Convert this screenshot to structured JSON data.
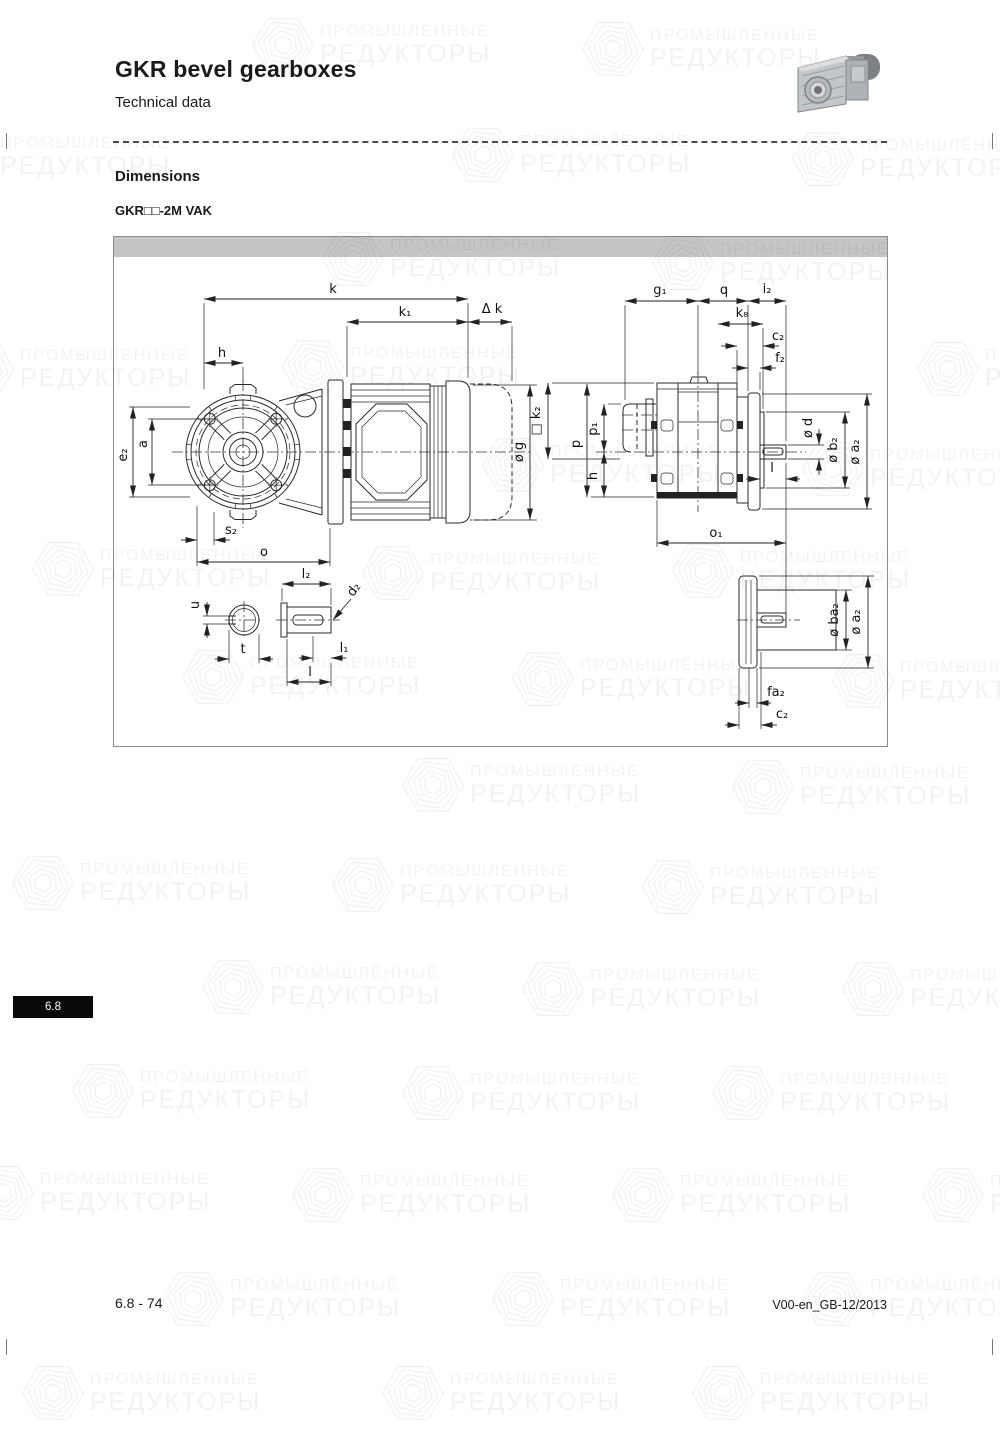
{
  "page": {
    "title": "GKR bevel gearboxes",
    "subtitle": "Technical data",
    "section_heading": "Dimensions",
    "variant_label": "GKR□□-2M VAK",
    "tab_label": "6.8",
    "footer_left": "6.8 - 74",
    "footer_right": "V00-en_GB-12/2013"
  },
  "watermark": {
    "line1": "ПРОМЫШЛЕННЫЕ",
    "line2": "РЕДУКТОРЫ"
  },
  "colors": {
    "panel_bar": "#c5c5c5",
    "tab_bg": "#0a0a0a",
    "line": "#2a2a2a"
  },
  "dims": {
    "k": "k",
    "k1": "k₁",
    "dk": "Δ k",
    "h": "h",
    "a": "a",
    "e2": "e₂",
    "og": "ø g",
    "s2": "s₂",
    "o": "o",
    "u": "u",
    "t": "t",
    "l2": "l₂",
    "d2": "d₂",
    "l1": "l₁",
    "l": "l",
    "g1": "g₁",
    "q": "q",
    "i2": "i₂",
    "k8": "k₈",
    "c2": "c₂",
    "f2": "f₂",
    "k2": "□ k₂",
    "p": "p",
    "p1": "p₁",
    "h2": "h",
    "od": "ø d",
    "ob2": "ø b₂",
    "oa2": "ø a₂",
    "l3": "l",
    "o1": "o₁",
    "oba2": "ø ba₂",
    "oa2b": "ø a₂",
    "fa2": "fa₂",
    "c2b": "c₂"
  }
}
